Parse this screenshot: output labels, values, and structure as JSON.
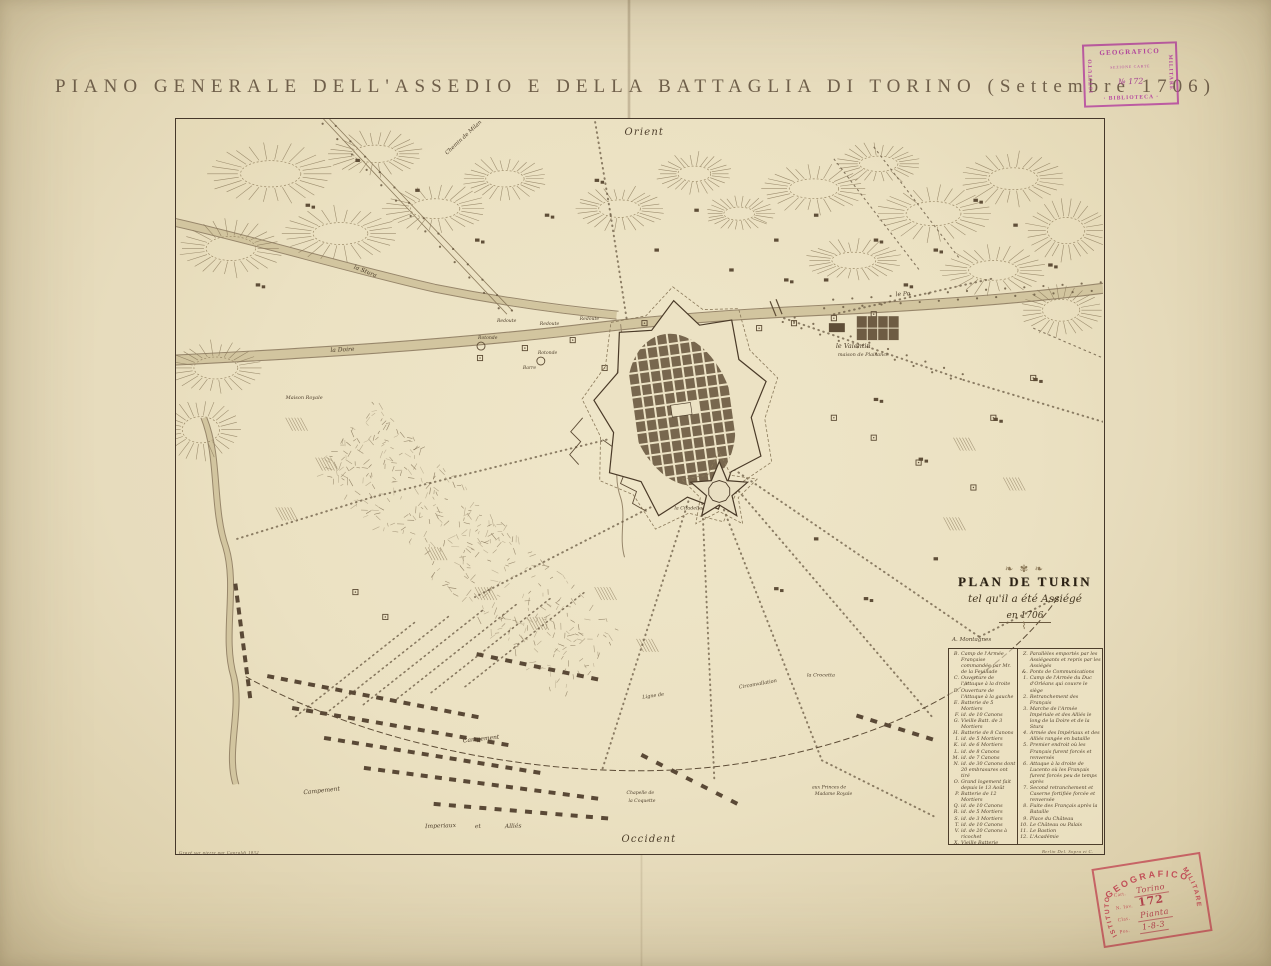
{
  "page": {
    "title": "PIANO GENERALE DELL'ASSEDIO E DELLA BATTAGLIA DI TORINO (Settembre 1706)",
    "paper_color": "#e7dcbd",
    "ink_color": "#4d3e2b"
  },
  "cartouche": {
    "title": "PLAN DE TURIN",
    "subtitle": "tel qu'il a été Assiégé",
    "year": "en 1706"
  },
  "legend": {
    "pre": "A. Montagnes",
    "left": [
      {
        "k": "B",
        "t": "Camp de l'Armée Française commandée par Mr. de la Feuillade"
      },
      {
        "k": "C",
        "t": "Ouverture de l'Attaque à la droite"
      },
      {
        "k": "D",
        "t": "Ouverture de l'Attaque à la gauche"
      },
      {
        "k": "E",
        "t": "Batterie de 5 Mortiers"
      },
      {
        "k": "F",
        "t": "id. de 10 Canons"
      },
      {
        "k": "G",
        "t": "Vieille Batt. de 3 Mortiers"
      },
      {
        "k": "H",
        "t": "Batterie de 8 Canons"
      },
      {
        "k": "I",
        "t": "id. de 5 Mortiers"
      },
      {
        "k": "K",
        "t": "id. de 6 Mortiers"
      },
      {
        "k": "L",
        "t": "id. de 8 Canons"
      },
      {
        "k": "M",
        "t": "id. de 7 Canons"
      },
      {
        "k": "N",
        "t": "id. de 30 Canons dont 20 embrasures ont tiré"
      },
      {
        "k": "O",
        "t": "Grand logement fait depuis le 13 Août"
      },
      {
        "k": "P",
        "t": "Batterie de 12 Mortiers"
      },
      {
        "k": "Q",
        "t": "id. de 10 Canons"
      },
      {
        "k": "R",
        "t": "id. de 5 Mortiers"
      },
      {
        "k": "S",
        "t": "id. de 3 Mortiers"
      },
      {
        "k": "T",
        "t": "id. de 10 Canons"
      },
      {
        "k": "V",
        "t": "id. de 20 Canons à ricochet"
      },
      {
        "k": "X",
        "t": "Vieille Batterie"
      },
      {
        "k": "Y",
        "t": "Redoutes pour couvrir les attaques"
      }
    ],
    "right": [
      {
        "k": "Z",
        "t": "Parallèles emportés par les Assiégeants et repris par les Assiégés"
      },
      {
        "k": "&",
        "t": "Ponts de Communications"
      },
      {
        "k": "1",
        "t": "Camp de l'Armée du Duc d'Orléans qui couvre le siège"
      },
      {
        "k": "2",
        "t": "Retranchement des Français"
      },
      {
        "k": "3",
        "t": "Marche de l'Armée Impériale et des Alliés le long de la Doire et de la Stura"
      },
      {
        "k": "4",
        "t": "Armée des Impériaux et des Alliés rangée en bataille"
      },
      {
        "k": "5",
        "t": "Premier endroit où les Français furent forcés et renversés"
      },
      {
        "k": "6",
        "t": "Attaque à la droite de Lucento où les Français furent forcés peu de temps après"
      },
      {
        "k": "7",
        "t": "Second retranchement et Caserne fortifiée forcée et renversée"
      },
      {
        "k": "8",
        "t": "Fuite des Français après la Bataille"
      },
      {
        "k": "9",
        "t": "Place du Château"
      },
      {
        "k": "10",
        "t": "Le Château ou Palais"
      },
      {
        "k": "11",
        "t": "Le Bastion"
      },
      {
        "k": "12",
        "t": "L'Académie"
      }
    ]
  },
  "map": {
    "imprint_left": "Gravé sur pierre par Capraldi 1832",
    "imprint_right": "Berlin Del. Sopra et C.",
    "labels": [
      {
        "t": "Orient",
        "x": 450,
        "y": 16,
        "s": 10,
        "r": 0
      },
      {
        "t": "Occident",
        "x": 447,
        "y": 726,
        "s": 10,
        "r": 0
      },
      {
        "t": "le Valentin",
        "x": 662,
        "y": 230,
        "s": 6.5,
        "r": 0
      },
      {
        "t": "maison de Plaisance",
        "x": 664,
        "y": 238,
        "s": 5,
        "r": 0
      },
      {
        "t": "Chemin de Milan",
        "x": 272,
        "y": 36,
        "s": 5.5,
        "r": -43
      },
      {
        "t": "Redoute",
        "x": 322,
        "y": 204,
        "s": 4.6,
        "r": 0
      },
      {
        "t": "Redoute",
        "x": 365,
        "y": 207,
        "s": 4.6,
        "r": 0
      },
      {
        "t": "Redoute",
        "x": 405,
        "y": 202,
        "s": 4.6,
        "r": 0
      },
      {
        "t": "Rotonde",
        "x": 303,
        "y": 221,
        "s": 4.6,
        "r": 0
      },
      {
        "t": "Rotonde",
        "x": 363,
        "y": 236,
        "s": 4.6,
        "r": 0
      },
      {
        "t": "Barre",
        "x": 348,
        "y": 251,
        "s": 4.6,
        "r": 0
      },
      {
        "t": "le Po",
        "x": 722,
        "y": 178,
        "s": 6,
        "r": -4
      },
      {
        "t": "la Doire",
        "x": 155,
        "y": 234,
        "s": 6,
        "r": -3
      },
      {
        "t": "la Stura",
        "x": 178,
        "y": 150,
        "s": 6,
        "r": 22
      },
      {
        "t": "la Citadelle",
        "x": 500,
        "y": 392,
        "s": 4.8,
        "r": 0
      },
      {
        "t": "Maison Royale",
        "x": 110,
        "y": 281,
        "s": 5,
        "r": 0
      },
      {
        "t": "Campement",
        "x": 128,
        "y": 678,
        "s": 6,
        "r": -6
      },
      {
        "t": "Campement",
        "x": 288,
        "y": 626,
        "s": 6,
        "r": -6
      },
      {
        "t": "Imperiaux",
        "x": 250,
        "y": 712,
        "s": 6,
        "r": -2
      },
      {
        "t": "et",
        "x": 300,
        "y": 712,
        "s": 6,
        "r": -2
      },
      {
        "t": "Alliés",
        "x": 330,
        "y": 712,
        "s": 6,
        "r": -2
      },
      {
        "t": "Ligne de",
        "x": 468,
        "y": 582,
        "s": 5,
        "r": -8
      },
      {
        "t": "Circonvallation",
        "x": 565,
        "y": 572,
        "s": 5,
        "r": -10
      },
      {
        "t": "la Crocetta",
        "x": 633,
        "y": 560,
        "s": 5,
        "r": 0
      },
      {
        "t": "aux Princes de",
        "x": 638,
        "y": 672,
        "s": 4.6,
        "r": 0
      },
      {
        "t": "Madame Royale",
        "x": 641,
        "y": 679,
        "s": 4.6,
        "r": 0
      },
      {
        "t": "Chapelle de",
        "x": 452,
        "y": 678,
        "s": 4.6,
        "r": 0
      },
      {
        "t": "la Coquette",
        "x": 454,
        "y": 686,
        "s": 4.6,
        "r": 0
      }
    ]
  },
  "stamps": {
    "library": {
      "color": "#b23a9e",
      "left": "ISTITUTO",
      "top": "GEOGRAFICO",
      "row2": "SEZIONE CARTE",
      "number": "№ 172",
      "bottom": "· BIBLIOTECA ·",
      "right": "MILITARE"
    },
    "catalog": {
      "color": "#c24a55",
      "arc_top": "GEOGRAFICO",
      "left": "ISTITUTO",
      "right": "MILITARE",
      "rows": [
        {
          "label": "Cart.",
          "value": "Torino",
          "style": "hand"
        },
        {
          "label": "N. Inv.",
          "value": "172",
          "style": "big"
        },
        {
          "label": "Clas.",
          "value": "Pianta",
          "style": "hand"
        },
        {
          "label": "Pos.",
          "value": "1-8-3",
          "style": "hand"
        }
      ]
    }
  }
}
